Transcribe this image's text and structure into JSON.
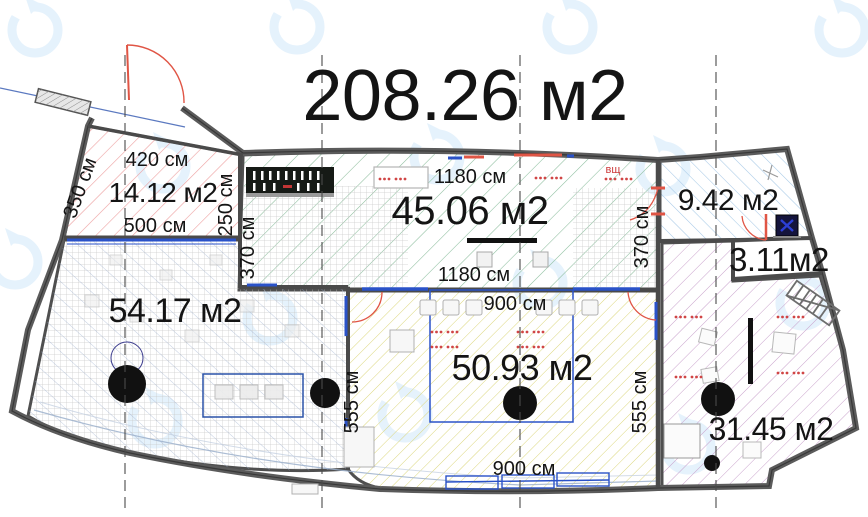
{
  "title": "208.26 м2",
  "rooms": {
    "room1": {
      "area": "14.12 м2",
      "dim_top": "420 см",
      "dim_bottom": "500 см",
      "dim_left": "350 см",
      "dim_right": "250 см"
    },
    "room2": {
      "area": "45.06 м2",
      "dim_top": "1180 см",
      "dim_bottom": "1180 см",
      "dim_left": "370 см",
      "dim_right": "370 см",
      "note": "вщ"
    },
    "room3": {
      "area": "9.42 м2"
    },
    "room4": {
      "area": "3.11м2"
    },
    "room5": {
      "area": "54.17 м2"
    },
    "room6": {
      "area": "50.93 м2",
      "dim_top": "900 см",
      "dim_bottom": "900 см",
      "dim_left": "555 см",
      "dim_right": "555 см"
    },
    "room7": {
      "area": "31.45 м2"
    }
  },
  "colors": {
    "wall": "#5b5b5b",
    "wall_dark": "#383838",
    "hatch_red": "#eda0a0",
    "hatch_green": "#8cbd9d",
    "hatch_blue": "#a6c9e6",
    "hatch_yellow": "#dcd77d",
    "hatch_purple": "#c9a2cc",
    "grid_gray": "#c9c9c9",
    "diag_navy": "#93a7c9",
    "window_blue": "#2a52c8",
    "door_red": "#e05545",
    "column_black": "#111111",
    "watermark_blue": "#cfe7f9",
    "axis_gray": "#4a4a4a",
    "red_dots": "#d04545"
  }
}
